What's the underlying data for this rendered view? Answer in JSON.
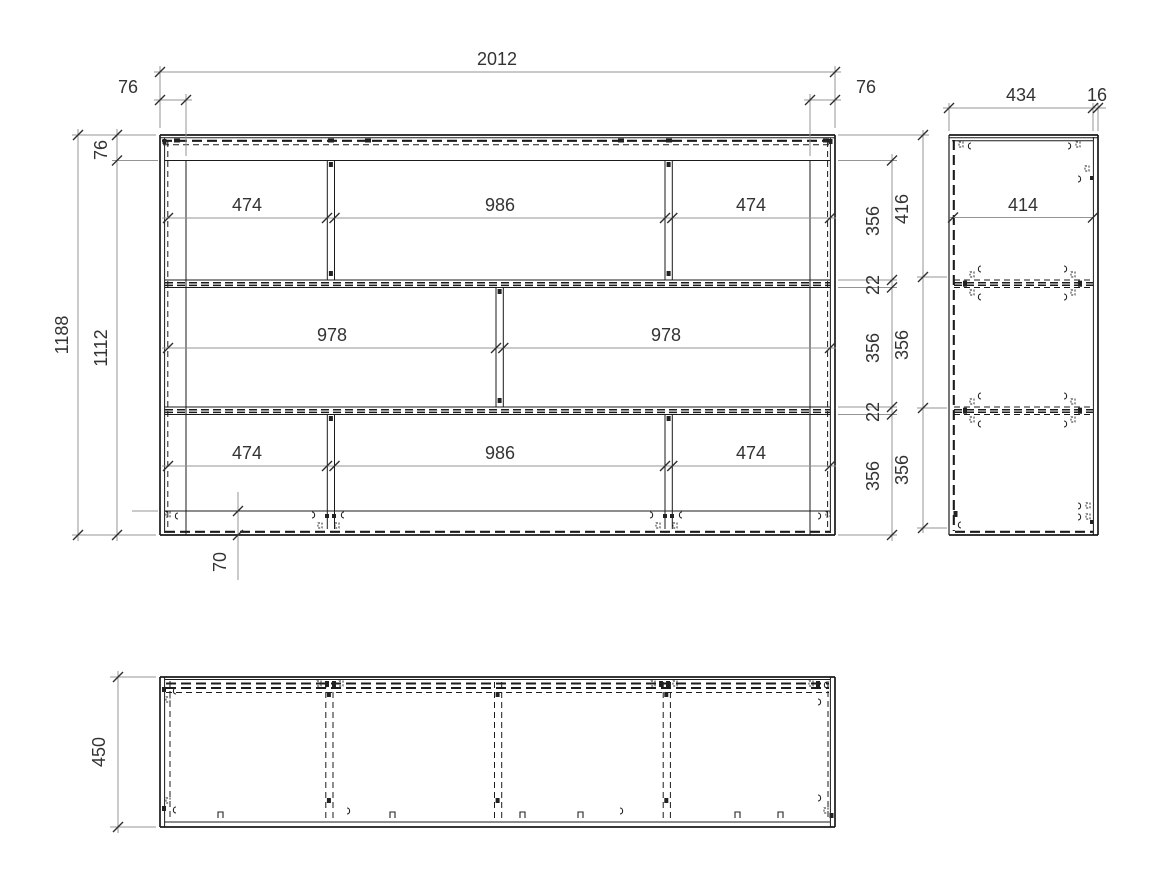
{
  "drawing": {
    "front": {
      "overall_width": "2012",
      "inset_left": "76",
      "inset_right": "76",
      "height_total": "1188",
      "top_rail": "76",
      "height_inner": "1112",
      "row_top": [
        "474",
        "986",
        "474"
      ],
      "row_mid": [
        "978",
        "978"
      ],
      "row_bottom": [
        "474",
        "986",
        "474"
      ],
      "chain": [
        "356",
        "22",
        "356",
        "22",
        "356"
      ],
      "plinth": "70"
    },
    "side": {
      "depth": "434",
      "edge": "16",
      "inner": "414",
      "chain": [
        "416",
        "356",
        "356"
      ]
    },
    "plan": {
      "depth": "450"
    }
  }
}
